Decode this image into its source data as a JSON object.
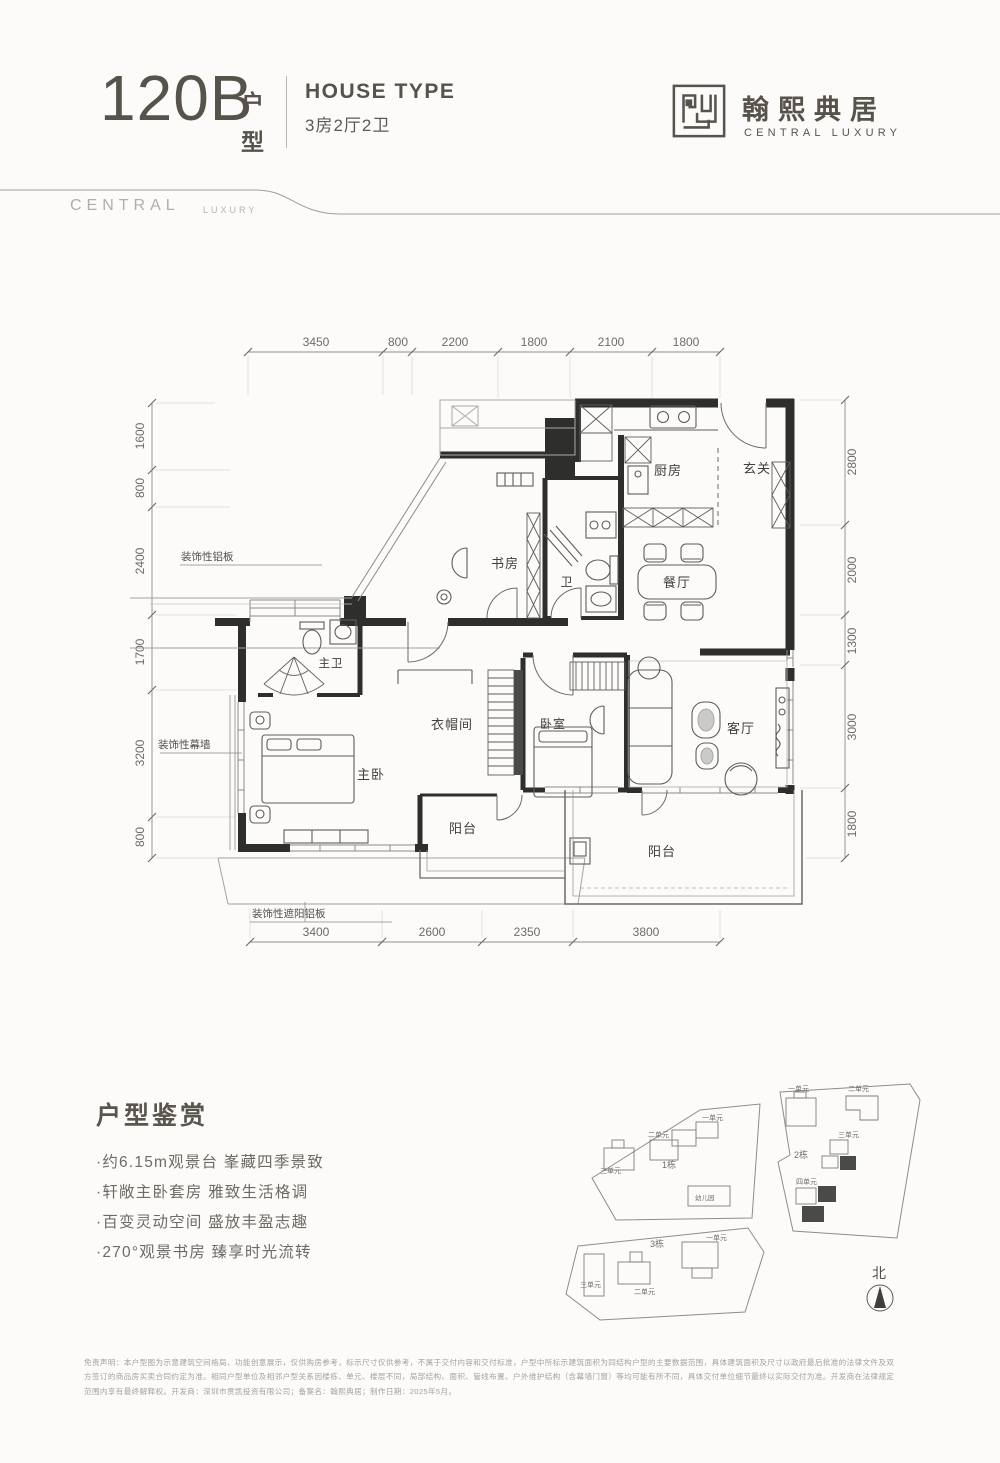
{
  "header": {
    "unit_code": "120B",
    "unit_suffix_1": "户",
    "unit_suffix_2": "型",
    "house_type_label": "HOUSE TYPE",
    "house_type_spec": "3房2厅2卫"
  },
  "brand": {
    "name_cn": "翰熙典居",
    "name_en": "CENTRAL LUXURY",
    "watermark_word": "CENTRAL",
    "watermark_sub": "LUXURY"
  },
  "floorplan": {
    "dims_top": [
      "3450",
      "800",
      "2200",
      "1800",
      "2100",
      "1800"
    ],
    "dims_bottom": [
      "3400",
      "2600",
      "2350",
      "3800"
    ],
    "dims_left": [
      "1600",
      "800",
      "2400",
      "1700",
      "3200",
      "800"
    ],
    "dims_right": [
      "2800",
      "2000",
      "1300",
      "3000",
      "1800"
    ],
    "rooms": {
      "kitchen": "厨房",
      "foyer": "玄关",
      "study": "书房",
      "bath": "卫",
      "dining": "餐厅",
      "master_bath": "主卫",
      "cloakroom": "衣帽间",
      "bedroom": "卧室",
      "living": "客厅",
      "master_bedroom": "主卧",
      "balcony": "阳台"
    },
    "annotations": {
      "alum_panel": "装饰性铝板",
      "curtain_wall": "装饰性幕墙",
      "sunshade_panel": "装饰性遮阳铝板"
    }
  },
  "highlights": {
    "title": "户型鉴赏",
    "items": [
      "·约6.15m观景台 峯藏四季景致",
      "·轩敞主卧套房 雅致生活格调",
      "·百变灵动空间 盛放丰盈志趣",
      "·270°观景书房 臻享时光流转"
    ]
  },
  "siteplan": {
    "building_1": "1栋",
    "building_2": "2栋",
    "building_3": "3栋",
    "kindergarten": "幼儿园",
    "north": "北",
    "units": {
      "u1": "一单元",
      "u2": "二单元",
      "u3": "三单元",
      "u4": "四单元"
    }
  },
  "disclaimer": {
    "line1": "免责声明：本户型图为示意建筑空间格局、功能创意展示，仅供购房参考，标示尺寸仅供参考，不属于交付内容和交付标准，户型中所标示建筑面积为同结构户型的主要数据范围，具体建筑面积及尺寸以政府最后批准的法律文件及双",
    "line2": "方签订的商品房买卖合同约定为准。相同户型单位及相邻户型关系因楼栋、单元、楼层不同，局部结构、面积、管线布置、户外维护结构（含幕墙门窗）等均可能有所不同，具体交付单位细节最终以实际交付为准。开发商在法律规定",
    "line3": "范围内享有最终解释权。开发商：深圳市贯凯投资有限公司；备案名：翰熙典居；制作日期：2025年5月。"
  }
}
